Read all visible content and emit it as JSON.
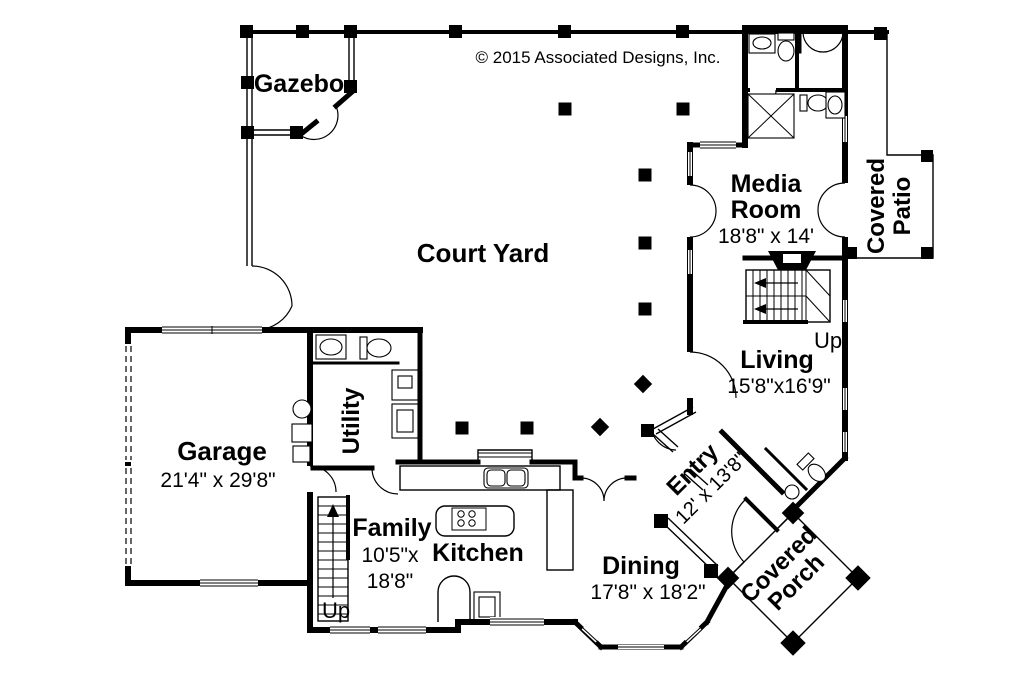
{
  "copyright": "© 2015 Associated Designs, Inc.",
  "colors": {
    "ink": "#000000",
    "background": "#ffffff"
  },
  "rooms": {
    "gazebo": {
      "name": "Gazebo"
    },
    "court_yard": {
      "name": "Court Yard"
    },
    "media_room": {
      "line1": "Media",
      "line2": "Room",
      "dims": "18'8\" x 14'"
    },
    "covered_patio": {
      "line1": "Covered",
      "line2": "Patio"
    },
    "living": {
      "name": "Living",
      "dims": "15'8\"x16'9\""
    },
    "garage": {
      "name": "Garage",
      "dims": "21'4\" x 29'8\""
    },
    "utility": {
      "name": "Utility"
    },
    "family": {
      "name": "Family",
      "dims_line1": "10'5\"x",
      "dims_line2": "18'8\""
    },
    "kitchen": {
      "name": "Kitchen"
    },
    "dining": {
      "name": "Dining",
      "dims": "17'8\" x 18'2\""
    },
    "entry": {
      "name": "Entry",
      "dims": "12' x 13'8\""
    },
    "covered_porch": {
      "line1": "Covered",
      "line2": "Porch"
    }
  },
  "stairs": {
    "upper_label": "Up",
    "lower_label": "Up"
  }
}
